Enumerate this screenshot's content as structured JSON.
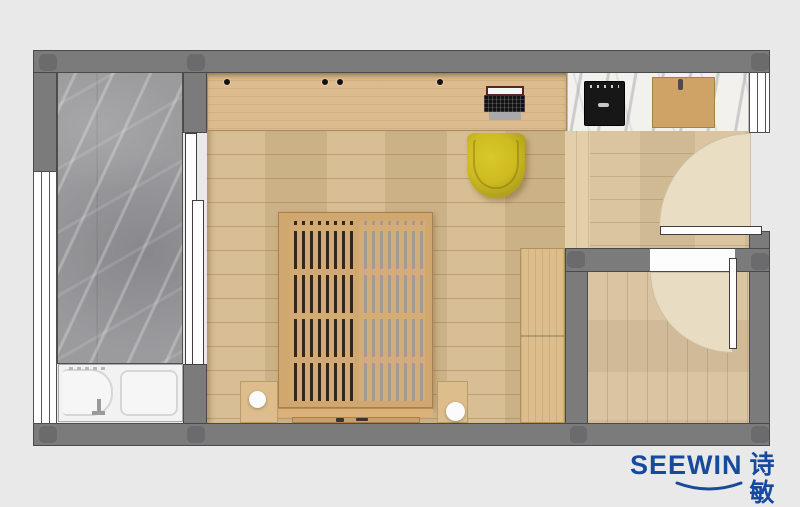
{
  "branding": {
    "logo_text": "SEEWIN",
    "logo_cjk": "诗敏",
    "logo_color": "#17499e"
  },
  "palette": {
    "background": "#e9e9e9",
    "wall": "#7b7b7b",
    "wall_column": "#6b6b6d",
    "wood_floor": "#d6ba8d",
    "wood_desk": "#dcbc8e",
    "entry_floor": "#d9c199",
    "door_swing_highlight": "#e9ddc3",
    "bed_frame": "#d0a76f",
    "bed_slat_gap_dark": "#32271b",
    "bed_slat_gap_light": "#a39a94",
    "wardrobe": "#dcbd8c",
    "marble_counter": "#f2f1ee",
    "marble_bathroom": "#9b9b9e",
    "fixture_white": "#f2f2f2",
    "accent_chair_yellow": "#cdbb20",
    "cooktop_black": "#171717",
    "cutting_board": "#cfa266"
  },
  "floor_plan": {
    "view": "top-down furniture plan",
    "rooms": [
      "bathroom",
      "main-room",
      "kitchen-counter-zone",
      "entry",
      "secondary-room"
    ],
    "furniture": [
      "shower-tub-unit",
      "bath-faucet",
      "sliding-door",
      "left-window",
      "desk-counter",
      "laptop",
      "desk-knobs",
      "yellow-desk-chair",
      "platform-slat-bed",
      "bed-footboard",
      "nightstand-left",
      "nightstand-right",
      "table-lamp-left",
      "table-lamp-right",
      "wardrobe",
      "kitchen-marble-counter",
      "cooktop",
      "cutting-board",
      "right-window",
      "entry-door",
      "entry-door-swing",
      "room-door",
      "room-door-swing"
    ]
  }
}
